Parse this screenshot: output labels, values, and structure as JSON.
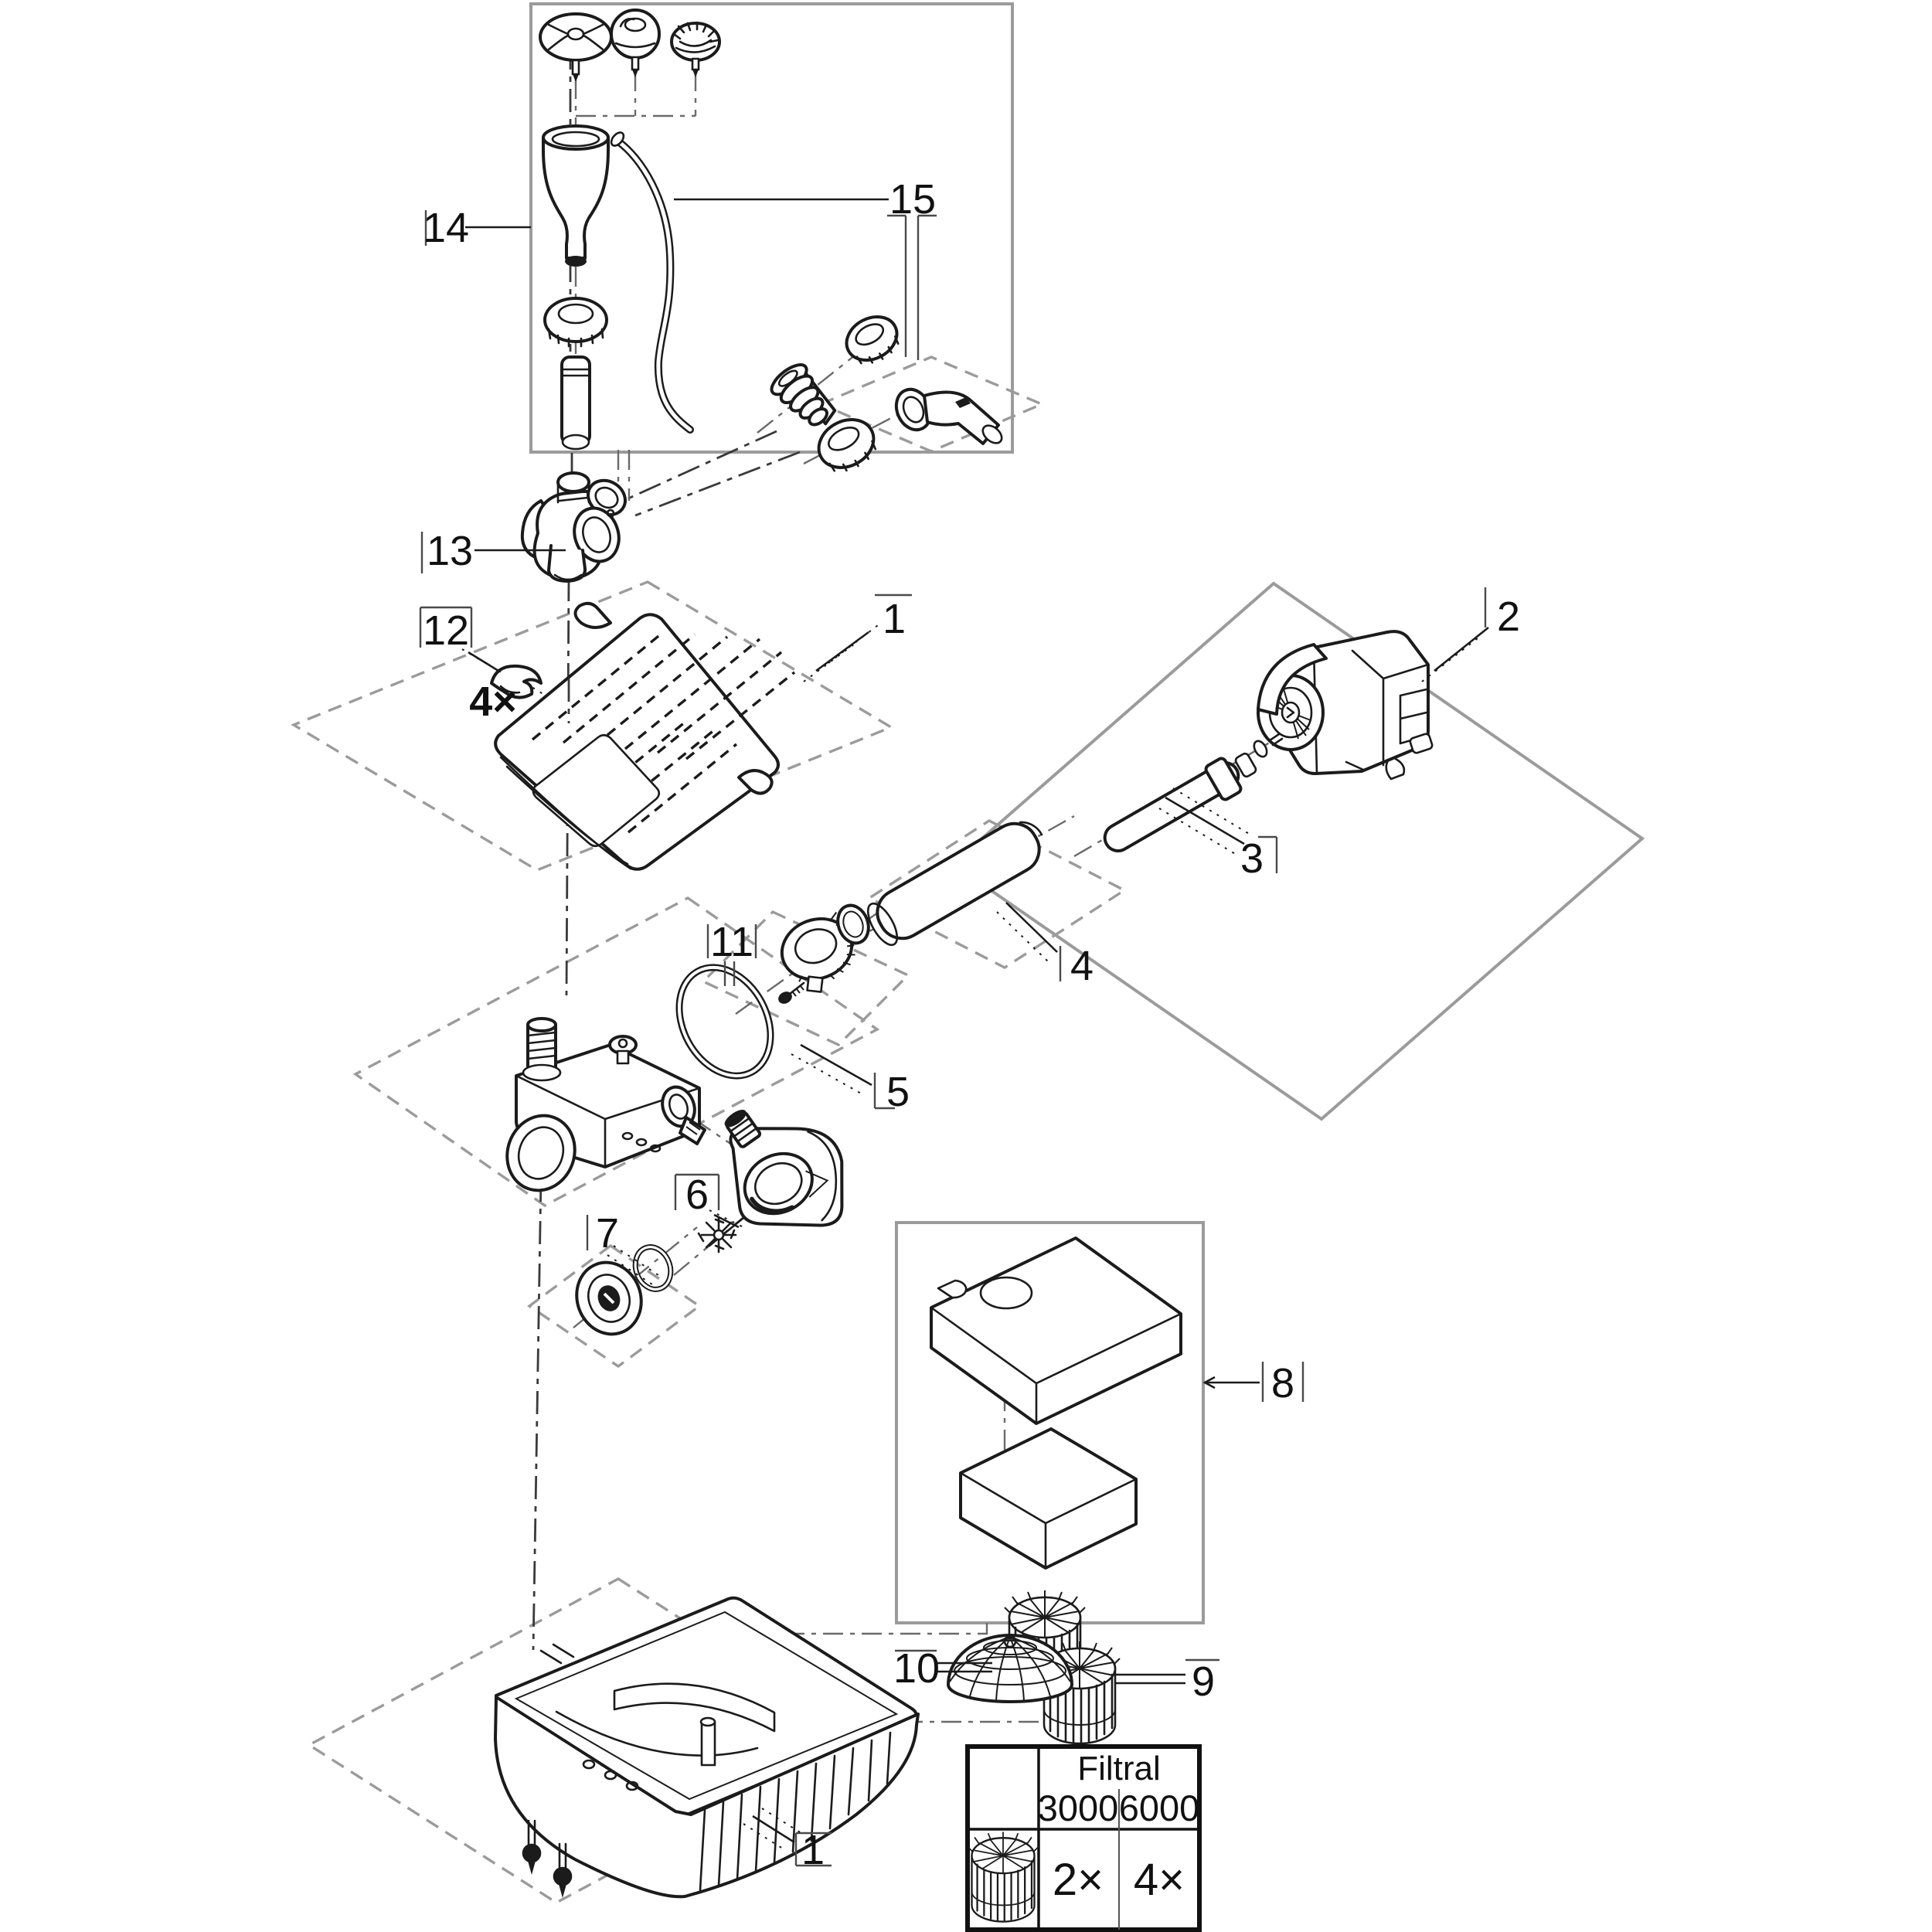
{
  "meta": {
    "description": "Filtral pond filter exploded parts diagram"
  },
  "colors": {
    "background": "#ffffff",
    "ink": "#1b1b1b",
    "frame": "#9b9b9b"
  },
  "callouts": {
    "part1_top": "1",
    "part1_bottom": "1",
    "part2": "2",
    "part3": "3",
    "part4": "4",
    "part5": "5",
    "part6": "6",
    "part7": "7",
    "part8": "8",
    "part9": "9",
    "part10": "10",
    "part11": "11",
    "part12": "12",
    "part13": "13",
    "part14": "14",
    "part15": "15",
    "clip_quantity": "4×"
  },
  "table": {
    "title": "Filtral",
    "model_columns": [
      "3000",
      "6000"
    ],
    "rows": [
      {
        "item_icon": "filter-cartridge-icon",
        "quantities": [
          "2×",
          "4×"
        ]
      }
    ]
  }
}
